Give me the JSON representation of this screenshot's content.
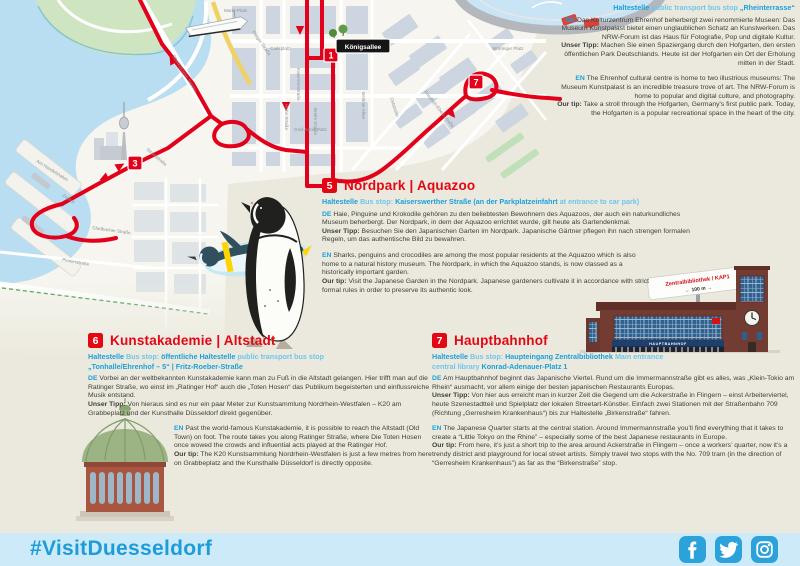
{
  "labels": {
    "de": "DE",
    "en": "EN",
    "tip_de": "Unser Tipp:",
    "tip_en": "Our tip:"
  },
  "ehrenhof": {
    "stop_b1": "Haltestelle",
    "stop_r1": "public transport bus stop",
    "stop_b2": "„Rheinterrasse“",
    "de": "Das Kulturzentrum Ehrenhof beherbergt zwei renommierte Museen: Das Museum Kunstpalast bietet einen unglaublichen Schatz an Kunstwerken. Das NRW-Forum ist das Haus für Fotografie, Pop und digitale Kultur.",
    "de_tip": "Machen Sie einen Spaziergang durch den Hofgarten, den ersten öffentlichen Park Deutschlands. Heute ist der Hofgarten ein Ort der Erholung mitten in der Stadt.",
    "en": "The Ehrenhof cultural centre is home to two illustrious museums: The Museum Kunstpalast is an incredible treasure trove of art. The NRW-Forum is home to popular and digital culture, and photography.",
    "en_tip": "Take a stroll through the Hofgarten, Germany's first public park. Today, the Hofgarten is a popular recreational space in the heart of the city."
  },
  "sections": {
    "nordpark": {
      "number": "5",
      "title": "Nordpark | Aquazoo",
      "stop": {
        "b1": "Haltestelle",
        "r1": "Bus stop:",
        "b2": "Kaiserswerther Straße (an der Parkplatzeinfahrt",
        "r2": "at entrance to car park)"
      },
      "de": "Haie, Pinguine und Krokodile gehören zu den beliebtesten Bewohnern des Aquazoos, der auch ein naturkundliches Museum beherbergt. Der Nordpark, in dem der Aquazoo errichtet wurde, gilt heute als Gartendenkmal.",
      "de_tip": "Besuchen Sie den Japanischen Garten im Nordpark. Japanische Gärtner pflegen ihn nach strengen formalen Regeln, um das authentische Bild zu bewahren.",
      "en": "Sharks, penguins and crocodiles are among the most popular residents at the Aquazoo which is also home to a natural history museum. The Nordpark, in which the Aquazoo stands, is now classed as a historically important garden.",
      "en_tip": "Visit the Japanese Garden in the Nordpark. Japanese gardeners cultivate it in accordance with strict formal rules in order to preserve its authentic look."
    },
    "kunstakademie": {
      "number": "6",
      "title": "Kunstakademie | Altstadt",
      "stop": {
        "b1": "Haltestelle",
        "r1": "Bus stop:",
        "b2": "öffentliche Haltestelle",
        "r2": "public transport bus stop",
        "line2": "„Tonhalle/Ehrenhof – 5“ | Fritz-Roeber-Straße"
      },
      "de": "Vorbei an der weltbekannten Kunstakademie kann man zu Fuß in die Altstadt gelangen. Hier trifft man auf die Ratinger Straße, wo einst im „Ratinger Hof“ auch die „Toten Hosen“ das Publikum begeisterten und einflussreiche Musik entstand.",
      "de_tip": "Von hieraus sind es nur ein paar Meter zur Kunstsammlung Nordrhein-Westfalen – K20 am Grabbeplatz und der Kunsthalle Düsseldorf direkt gegenüber.",
      "en": "Past the world-famous Kunstakademie, it is possible to reach the Altstadt (Old Town) on foot. The route takes you along Ratinger Straße, where Die Toten Hosen once wowed the crowds and influential acts played at the Ratinger Hof.",
      "en_tip": "The K20 Kunstsammlung Nordrhein-Westfalen is just a few metres from here on Grabbeplatz and the Kunsthalle Düsseldorf is directly opposite."
    },
    "hauptbahnhof": {
      "number": "7",
      "title": "Hauptbahnhof",
      "stop": {
        "b1": "Haltestelle",
        "r1": "Bus stop:",
        "b2": "Haupteingang Zentralbibliothek",
        "r2": "Main entrance central library",
        "b3": "Konrad-Adenauer-Platz 1"
      },
      "de": "Am Hauptbahnhof beginnt das Japanische Viertel. Rund um die Immermannstraße gibt es alles, was „Klein-Tokio am Rhein“ ausmacht, vor allem einige der besten japanischen Restaurants Europas.",
      "de_tip": "Von hier aus erreicht man in kurzer Zeit die Gegend um die Ackerstraße in Flingern – einst Arbeiterviertel, heute Szenestadtteil und Spielplatz der lokalen Streetart-Künstler. Einfach zwei Stationen mit der Straßenbahn 709 (Richtung „Gerresheim Krankenhaus“) bis zur Haltestelle „Birkenstraße“ fahren.",
      "en": "The Japanese Quarter starts at the central station. Around Immermannstraße you’ll find everything that it takes to create a “Little Tokyo on the Rhine” – especially some of the best Japanese restaurants in Europe.",
      "en_tip": "From here, it’s just a short trip to the area around Ackerstraße in Flingern – once a workers’ quarter, now it’s a trendy district and playground for local street artists. Simply travel two stops with the No. 709 tram (in the direction of “Gerresheim Krankenhaus”) as far as the “Birkenstraße” stop."
    }
  },
  "map": {
    "kings_sign": "Königsallee",
    "signpost_line1": "Zentralbibliothek / KAP1",
    "signpost_line2": "← 100 m →",
    "station_name": "HAUPTBAHNHOF",
    "markers": [
      {
        "n": "1",
        "x": 331,
        "y": 55
      },
      {
        "n": "3",
        "x": 135,
        "y": 163
      },
      {
        "n": "7",
        "x": 476,
        "y": 82
      }
    ],
    "street_labels": [
      {
        "t": "Markt-Platz",
        "x": 224,
        "y": 12,
        "r": 0
      },
      {
        "t": "Flinger Straße",
        "x": 252,
        "y": 32,
        "r": 55
      },
      {
        "t": "Carlsplatz",
        "x": 270,
        "y": 50,
        "r": 0
      },
      {
        "t": "Oberkasseler Brücke",
        "x": 172,
        "y": 56,
        "r": 58
      },
      {
        "t": "Kasernenstraße",
        "x": 297,
        "y": 68,
        "r": 90
      },
      {
        "t": "Hohe Straße",
        "x": 285,
        "y": 104,
        "r": 90
      },
      {
        "t": "Breite Straße",
        "x": 314,
        "y": 108,
        "r": 90
      },
      {
        "t": "Berliner Allee",
        "x": 362,
        "y": 92,
        "r": 90
      },
      {
        "t": "Oststraße",
        "x": 390,
        "y": 98,
        "r": 72
      },
      {
        "t": "Friedrich-Ebert-Straße",
        "x": 424,
        "y": 92,
        "r": 52
      },
      {
        "t": "Worringer Platz",
        "x": 492,
        "y": 50,
        "r": 0
      },
      {
        "t": "Graf-Adolf-Platz",
        "x": 294,
        "y": 131,
        "r": 0
      },
      {
        "t": "Stromstraße",
        "x": 146,
        "y": 150,
        "r": 40
      },
      {
        "t": "Am Handelshafen",
        "x": 36,
        "y": 162,
        "r": 32
      },
      {
        "t": "Zollhof",
        "x": 62,
        "y": 196,
        "r": 35
      },
      {
        "t": "Gladbacher Straße",
        "x": 92,
        "y": 229,
        "r": 8
      },
      {
        "t": "Pionierstraße",
        "x": 62,
        "y": 261,
        "r": 10
      }
    ]
  },
  "footer": {
    "hashtag": "#VisitDuesseldorf",
    "social_icons": [
      "facebook-icon",
      "twitter-icon",
      "instagram-icon"
    ]
  }
}
